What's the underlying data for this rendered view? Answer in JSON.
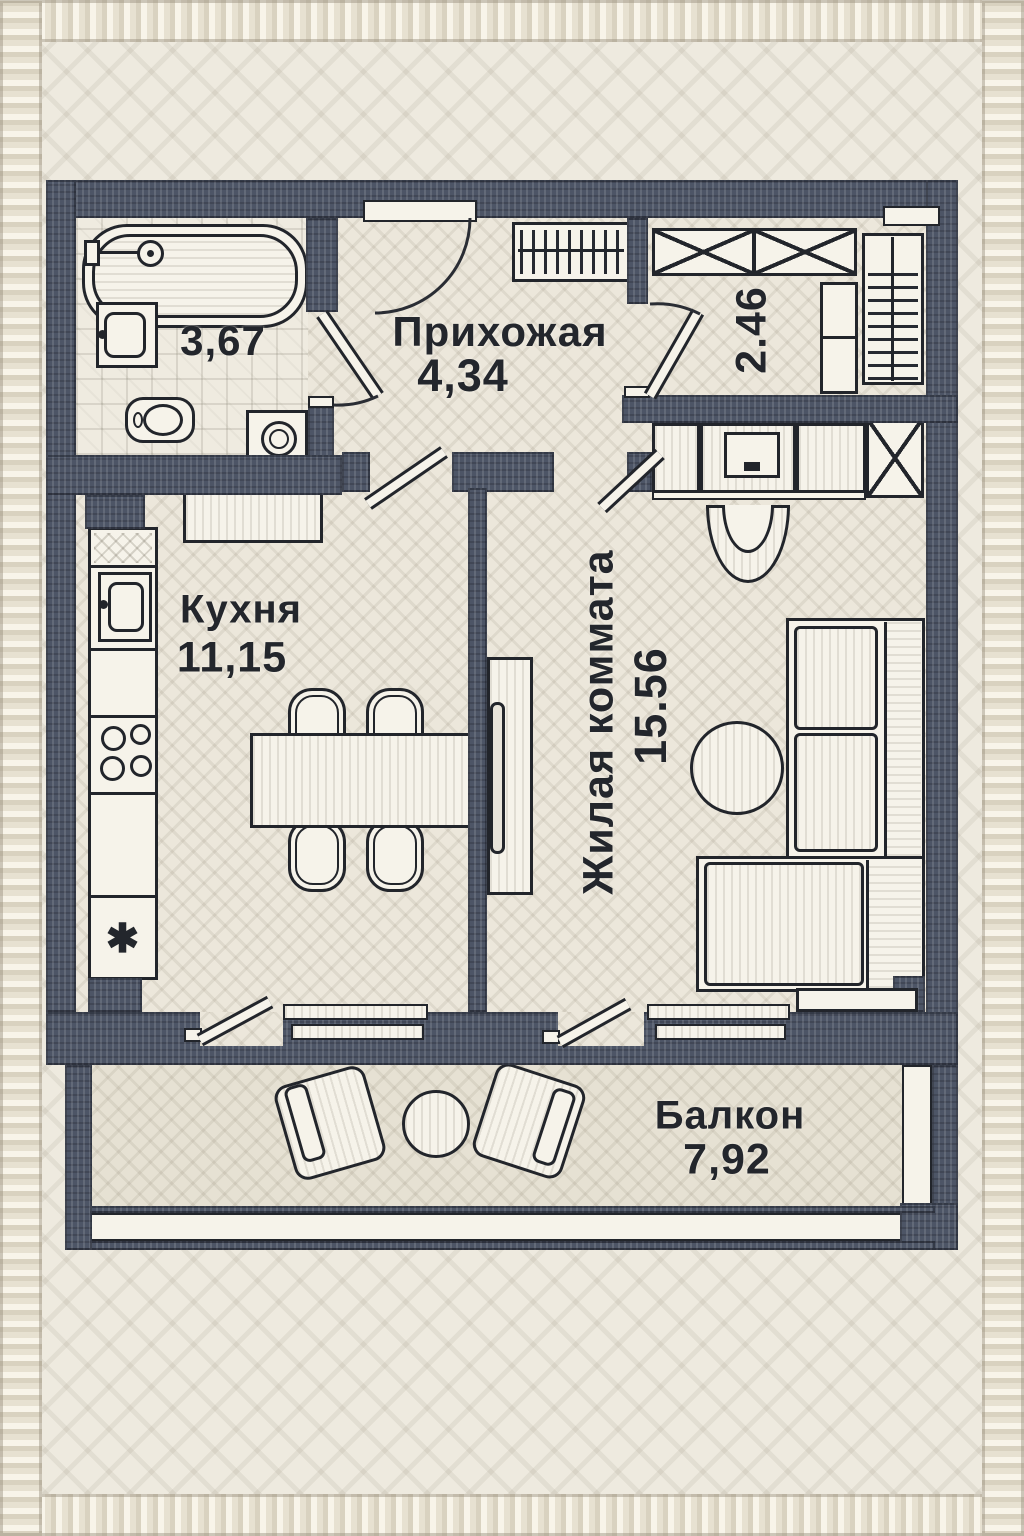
{
  "title": "Embroidered apartment floor plan",
  "rooms": {
    "bathroom": {
      "area": "3,67"
    },
    "hallway": {
      "name": "Прихожая",
      "area": "4,34"
    },
    "wardrobe": {
      "area": "2.46"
    },
    "kitchen": {
      "name": "Кухня",
      "area": "11,15"
    },
    "living_room": {
      "name": "Жилая коммата",
      "area": "15.56"
    },
    "balcony": {
      "name": "Балкон",
      "area": "7,92"
    }
  },
  "symbols": {
    "fridge": "✱"
  },
  "colors": {
    "wall": "#4d5566",
    "outline": "#22252b",
    "floor": "#ece7db",
    "furniture": "#f6f3ea"
  }
}
